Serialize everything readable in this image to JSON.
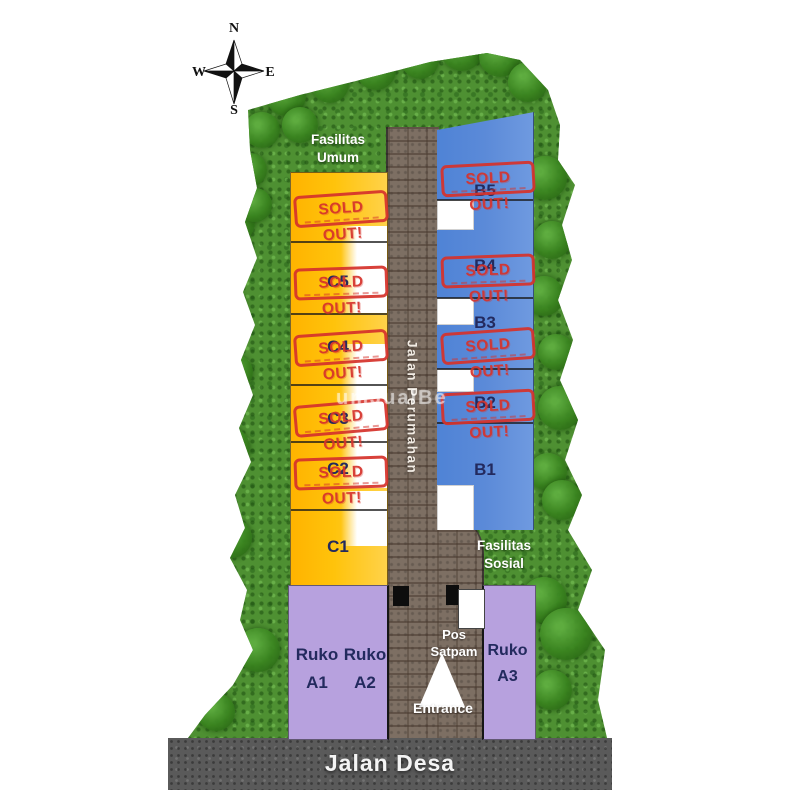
{
  "compass": {
    "n": "N",
    "e": "E",
    "s": "S",
    "w": "W"
  },
  "areas": {
    "fasilitas_umum": "Fasilitas Umum",
    "fasilitas_sosial": "Fasilitas Sosial",
    "jalan_perumahan": "Jalan Perumahan",
    "jalan_desa": "Jalan Desa",
    "pos_satpam": "Pos Satpam",
    "entrance": "Entrance"
  },
  "stamp": {
    "text": "SOLD OUT!"
  },
  "plots": {
    "c_column": [
      {
        "label": "",
        "sold": true
      },
      {
        "label": "C5",
        "sold": true
      },
      {
        "label": "C4",
        "sold": true
      },
      {
        "label": "C3",
        "sold": true
      },
      {
        "label": "C2",
        "sold": true
      },
      {
        "label": "C1",
        "sold": false
      }
    ],
    "b_column": [
      {
        "label": "B5",
        "sold": true
      },
      {
        "label": "B4",
        "sold": true
      },
      {
        "label": "B3",
        "sold": true
      },
      {
        "label": "B2",
        "sold": true
      },
      {
        "label": "B1",
        "sold": false
      }
    ],
    "ruko": [
      {
        "type": "Ruko",
        "unit": "A1"
      },
      {
        "type": "Ruko",
        "unit": "A2"
      },
      {
        "type": "Ruko",
        "unit": "A3"
      }
    ]
  },
  "watermark": "umJualBe",
  "colors": {
    "c_plot_yellow": "#FFC30B",
    "b_plot_blue": "#5B8AD8",
    "ruko_purple": "#B7A1DE",
    "stamp_red": "#D6332C",
    "brick_road": "#7D6F63",
    "asphalt": "#5A5A5A",
    "grass": "#4E9032",
    "label_navy": "#232A5E"
  }
}
